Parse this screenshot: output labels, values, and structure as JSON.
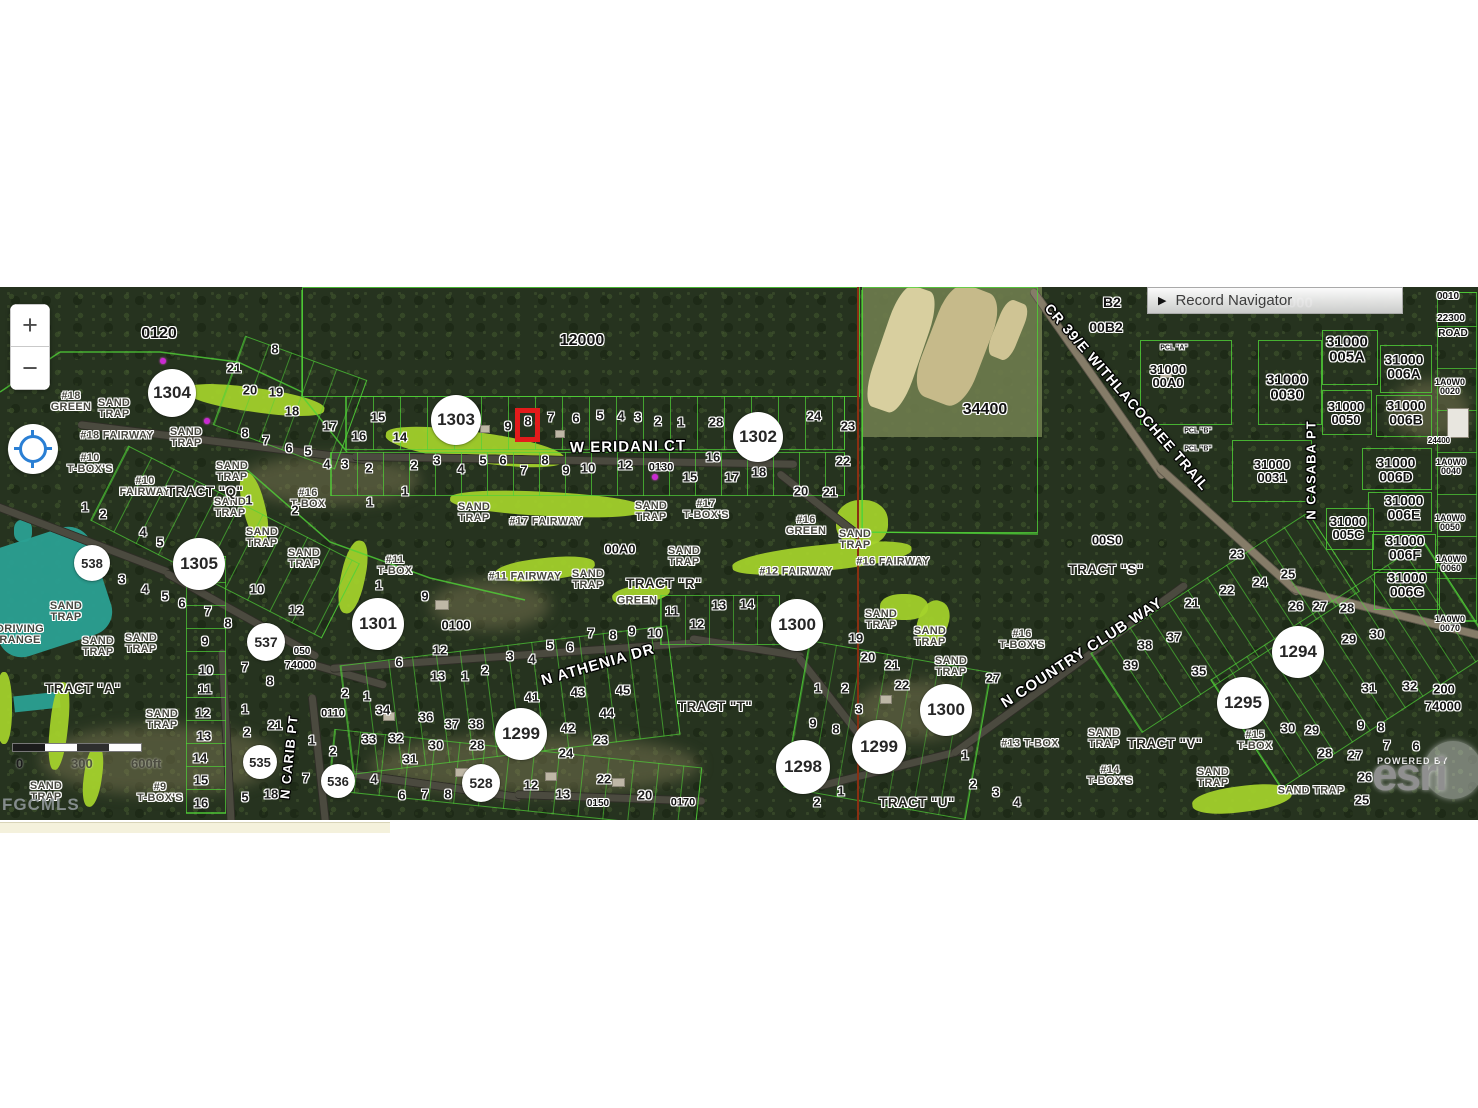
{
  "map": {
    "top": 287,
    "controls": {
      "zoom_in": "+",
      "zoom_out": "−"
    },
    "record_navigator": {
      "arrow": "▶",
      "label": "Record Navigator"
    },
    "scale_bar": {
      "start": "0",
      "mid": "300",
      "end": "600ft"
    },
    "attribution": {
      "powered_by": "POWERED BY",
      "brand": "esri",
      "mls": "FGCMLS"
    },
    "highlight": {
      "lot": "8",
      "x": 515,
      "y": 408,
      "w": 25,
      "h": 34,
      "color": "#e31b1b"
    },
    "circles": [
      [
        "1304",
        172,
        393,
        24
      ],
      [
        "1303",
        456,
        420,
        25
      ],
      [
        "1302",
        758,
        437,
        25
      ],
      [
        "538",
        92,
        563,
        18
      ],
      [
        "1305",
        199,
        564,
        26
      ],
      [
        "537",
        266,
        642,
        19
      ],
      [
        "1301",
        378,
        624,
        26
      ],
      [
        "1300",
        797,
        625,
        26
      ],
      [
        "1300",
        946,
        710,
        26
      ],
      [
        "1299",
        521,
        734,
        26
      ],
      [
        "1299",
        879,
        747,
        27
      ],
      [
        "1298",
        803,
        767,
        27
      ],
      [
        "1294",
        1298,
        652,
        26
      ],
      [
        "1295",
        1243,
        703,
        26
      ],
      [
        "535",
        260,
        762,
        17
      ],
      [
        "536",
        338,
        781,
        17
      ],
      [
        "528",
        481,
        783,
        19
      ]
    ],
    "streets": [
      [
        "W ERIDANI CT",
        628,
        447,
        -1,
        15
      ],
      [
        "N ATHENIA DR",
        598,
        665,
        -16,
        15
      ],
      [
        "N COUNTRY CLUB WAY",
        1082,
        653,
        -33,
        15
      ],
      [
        "CR 39/E WITHLACOCHEE TRAIL",
        1127,
        397,
        49,
        14
      ],
      [
        "N CASABA PT",
        1311,
        470,
        -90,
        13
      ],
      [
        "N CARIB PT",
        289,
        757,
        -84,
        13
      ]
    ],
    "tracts": [
      [
        "TRACT \"Q\"",
        205,
        492
      ],
      [
        "TRACT \"A\"",
        83,
        689
      ],
      [
        "TRACT \"R\"",
        664,
        584
      ],
      [
        "TRACT \"S\"",
        1106,
        570
      ],
      [
        "TRACT \"T\"",
        715,
        707
      ],
      [
        "TRACT \"U\"",
        917,
        803
      ],
      [
        "TRACT \"V\"",
        1165,
        744
      ]
    ],
    "golf": [
      [
        "#18\nGREEN",
        71,
        402
      ],
      [
        "SAND\nTRAP",
        114,
        409
      ],
      [
        "SAND\nTRAP",
        186,
        438
      ],
      [
        "#18 FAIRWAY",
        117,
        436
      ],
      [
        "#10\nT-BOX'S",
        90,
        464
      ],
      [
        "#10\nFAIRWAY",
        145,
        487
      ],
      [
        "SAND\nTRAP",
        232,
        472
      ],
      [
        "SAND\nTRAP",
        230,
        508
      ],
      [
        "#16\nT-BOX",
        308,
        499
      ],
      [
        "SAND\nTRAP",
        262,
        538
      ],
      [
        "SAND\nTRAP",
        304,
        559
      ],
      [
        "SAND\nTRAP",
        474,
        513
      ],
      [
        "#17 FAIRWAY",
        546,
        522
      ],
      [
        "#17\nT-BOX'S",
        706,
        510
      ],
      [
        "SAND\nTRAP",
        651,
        512
      ],
      [
        "SAND\nTRAP",
        684,
        557
      ],
      [
        "#11\nT-BOX",
        395,
        566
      ],
      [
        "#11 FAIRWAY",
        525,
        577
      ],
      [
        "SAND\nTRAP",
        588,
        580
      ],
      [
        "GREEN",
        637,
        601
      ],
      [
        "#12 FAIRWAY",
        796,
        572
      ],
      [
        "#16\nGREEN",
        806,
        526
      ],
      [
        "SAND\nTRAP",
        855,
        540
      ],
      [
        "#16 FAIRWAY",
        893,
        562
      ],
      [
        "SAND\nTRAP",
        881,
        620
      ],
      [
        "SAND\nTRAP",
        930,
        637
      ],
      [
        "SAND\nTRAP",
        951,
        667
      ],
      [
        "#16\nT-BOX'S",
        1022,
        640
      ],
      [
        "SAND\nTRAP",
        66,
        612
      ],
      [
        "SAND\nTRAP",
        98,
        647
      ],
      [
        "SAND\nTRAP",
        141,
        644
      ],
      [
        "SAND\nTRAP",
        162,
        720
      ],
      [
        "SAND\nTRAP",
        46,
        792
      ],
      [
        "#9\nT-BOX'S",
        160,
        793
      ],
      [
        "DRIVING\nRANGE",
        20,
        635
      ],
      [
        "#13 T-BOX",
        1030,
        744
      ],
      [
        "SAND\nTRAP",
        1104,
        739
      ],
      [
        "#14\nT-BOX'S",
        1110,
        776
      ],
      [
        "#15\nT-BOX",
        1255,
        741
      ],
      [
        "SAND\nTRAP",
        1213,
        778
      ],
      [
        "SAND TRAP",
        1311,
        791
      ]
    ],
    "parcels": [
      [
        "0120",
        159,
        334,
        16
      ],
      [
        "12000",
        582,
        341,
        16
      ],
      [
        "34400",
        985,
        410,
        16
      ],
      [
        "B2",
        1112,
        302,
        14
      ],
      [
        "00B2",
        1106,
        327,
        14
      ],
      [
        "0010",
        1448,
        297,
        10
      ],
      [
        "22300",
        1451,
        319,
        10
      ],
      [
        "ROAD",
        1453,
        334,
        10
      ],
      [
        "PCL \"A\"",
        1174,
        348,
        7
      ],
      [
        "31000\n00A0",
        1168,
        376,
        13
      ],
      [
        "PCL \"B\"",
        1198,
        431,
        7
      ],
      [
        "PCL \"B\"",
        1198,
        449,
        7
      ],
      [
        "31000\n005A",
        1347,
        350,
        15
      ],
      [
        "31000\n006A",
        1404,
        367,
        14
      ],
      [
        "31000\n0030",
        1287,
        388,
        15
      ],
      [
        "31000\n0050",
        1346,
        413,
        13
      ],
      [
        "31000\n006B",
        1406,
        413,
        14
      ],
      [
        "1A0W0\n0020",
        1450,
        387,
        9
      ],
      [
        "24400",
        1439,
        441,
        8
      ],
      [
        "31000\n0031",
        1272,
        471,
        13
      ],
      [
        "31000\n006D",
        1396,
        470,
        14
      ],
      [
        "1A0W0\n0040",
        1451,
        467,
        9
      ],
      [
        "31000\n006E",
        1404,
        508,
        14
      ],
      [
        "31000\n005C",
        1348,
        528,
        13
      ],
      [
        "1A0W0\n0050",
        1450,
        523,
        9
      ],
      [
        "31000\n006F",
        1405,
        548,
        14
      ],
      [
        "1A0W0\n0060",
        1451,
        564,
        9
      ],
      [
        "31000\n006G",
        1407,
        585,
        14
      ],
      [
        "1A0W0\n0070",
        1450,
        624,
        9
      ],
      [
        "00S0",
        1107,
        540,
        13
      ],
      [
        "00A0",
        620,
        549,
        13
      ],
      [
        "0130",
        661,
        468,
        11
      ],
      [
        "0100",
        456,
        625,
        13
      ],
      [
        "0110",
        333,
        714,
        11
      ],
      [
        "050",
        302,
        652,
        10
      ],
      [
        "74000",
        300,
        666,
        11
      ],
      [
        "200",
        1444,
        689,
        13
      ],
      [
        "74000",
        1443,
        706,
        13
      ],
      [
        "0150",
        598,
        804,
        10
      ],
      [
        "0170",
        683,
        803,
        11
      ],
      [
        "41000",
        1292,
        303,
        15,
        "ghost"
      ]
    ],
    "lots": [
      [
        "8",
        275,
        349
      ],
      [
        "21",
        234,
        368
      ],
      [
        "20",
        250,
        390
      ],
      [
        "19",
        276,
        392
      ],
      [
        "18",
        292,
        411
      ],
      [
        "8",
        245,
        433
      ],
      [
        "7",
        266,
        440
      ],
      [
        "6",
        289,
        448
      ],
      [
        "5",
        308,
        451
      ],
      [
        "1",
        249,
        500
      ],
      [
        "2",
        295,
        510
      ],
      [
        "17",
        330,
        426
      ],
      [
        "16",
        359,
        436
      ],
      [
        "15",
        378,
        417
      ],
      [
        "14",
        400,
        437
      ],
      [
        "4",
        327,
        464
      ],
      [
        "3",
        345,
        464
      ],
      [
        "2",
        369,
        468
      ],
      [
        "1",
        405,
        491
      ],
      [
        "1",
        370,
        502
      ],
      [
        "9",
        508,
        426
      ],
      [
        "8",
        528,
        421
      ],
      [
        "7",
        551,
        417
      ],
      [
        "6",
        576,
        418
      ],
      [
        "5",
        600,
        415
      ],
      [
        "4",
        621,
        416
      ],
      [
        "3",
        638,
        417
      ],
      [
        "2",
        658,
        421
      ],
      [
        "1",
        681,
        422
      ],
      [
        "28",
        716,
        422
      ],
      [
        "24",
        814,
        416
      ],
      [
        "23",
        848,
        426
      ],
      [
        "22",
        843,
        461
      ],
      [
        "20",
        801,
        491
      ],
      [
        "21",
        830,
        492
      ],
      [
        "16",
        713,
        457
      ],
      [
        "15",
        690,
        477
      ],
      [
        "17",
        732,
        477
      ],
      [
        "18",
        759,
        472
      ],
      [
        "2",
        414,
        465
      ],
      [
        "3",
        437,
        460
      ],
      [
        "4",
        461,
        469
      ],
      [
        "5",
        483,
        460
      ],
      [
        "6",
        503,
        460
      ],
      [
        "7",
        524,
        470
      ],
      [
        "8",
        545,
        460
      ],
      [
        "9",
        566,
        470
      ],
      [
        "10",
        588,
        468
      ],
      [
        "12",
        625,
        465
      ],
      [
        "1",
        85,
        507
      ],
      [
        "2",
        103,
        514
      ],
      [
        "4",
        143,
        532
      ],
      [
        "5",
        160,
        542
      ],
      [
        "3",
        122,
        579
      ],
      [
        "4",
        145,
        589
      ],
      [
        "5",
        165,
        596
      ],
      [
        "6",
        182,
        603
      ],
      [
        "7",
        208,
        611
      ],
      [
        "8",
        228,
        623
      ],
      [
        "9",
        205,
        641
      ],
      [
        "10",
        257,
        589
      ],
      [
        "12",
        296,
        610
      ],
      [
        "10",
        206,
        670
      ],
      [
        "11",
        205,
        689
      ],
      [
        "12",
        203,
        713
      ],
      [
        "13",
        204,
        736
      ],
      [
        "14",
        200,
        758
      ],
      [
        "15",
        201,
        780
      ],
      [
        "16",
        201,
        803
      ],
      [
        "7",
        245,
        667
      ],
      [
        "8",
        270,
        681
      ],
      [
        "1",
        245,
        709
      ],
      [
        "2",
        247,
        732
      ],
      [
        "21",
        275,
        725
      ],
      [
        "1",
        312,
        740
      ],
      [
        "2",
        333,
        751
      ],
      [
        "5",
        245,
        797
      ],
      [
        "18",
        271,
        794
      ],
      [
        "7",
        306,
        778
      ],
      [
        "1",
        379,
        585
      ],
      [
        "9",
        425,
        596
      ],
      [
        "12",
        440,
        650
      ],
      [
        "6",
        399,
        662
      ],
      [
        "13",
        438,
        676
      ],
      [
        "1",
        465,
        676
      ],
      [
        "2",
        485,
        670
      ],
      [
        "3",
        510,
        656
      ],
      [
        "4",
        532,
        659
      ],
      [
        "5",
        550,
        645
      ],
      [
        "6",
        570,
        647
      ],
      [
        "7",
        591,
        633
      ],
      [
        "8",
        613,
        635
      ],
      [
        "9",
        632,
        631
      ],
      [
        "10",
        655,
        633
      ],
      [
        "11",
        672,
        611
      ],
      [
        "12",
        697,
        624
      ],
      [
        "13",
        719,
        605
      ],
      [
        "14",
        747,
        604
      ],
      [
        "2",
        345,
        693
      ],
      [
        "1",
        367,
        696
      ],
      [
        "34",
        383,
        710
      ],
      [
        "36",
        426,
        717
      ],
      [
        "37",
        452,
        724
      ],
      [
        "38",
        476,
        724
      ],
      [
        "33",
        369,
        739
      ],
      [
        "32",
        396,
        738
      ],
      [
        "30",
        436,
        745
      ],
      [
        "28",
        477,
        745
      ],
      [
        "31",
        410,
        759
      ],
      [
        "41",
        532,
        697
      ],
      [
        "43",
        578,
        692
      ],
      [
        "45",
        623,
        690
      ],
      [
        "44",
        607,
        713
      ],
      [
        "42",
        568,
        728
      ],
      [
        "23",
        601,
        740
      ],
      [
        "24",
        566,
        753
      ],
      [
        "4",
        374,
        779
      ],
      [
        "6",
        402,
        795
      ],
      [
        "7",
        425,
        794
      ],
      [
        "8",
        448,
        794
      ],
      [
        "12",
        531,
        785
      ],
      [
        "13",
        563,
        794
      ],
      [
        "22",
        604,
        779
      ],
      [
        "20",
        645,
        795
      ],
      [
        "19",
        856,
        638
      ],
      [
        "20",
        868,
        657
      ],
      [
        "21",
        892,
        665
      ],
      [
        "22",
        902,
        685
      ],
      [
        "1",
        818,
        688
      ],
      [
        "2",
        845,
        688
      ],
      [
        "3",
        859,
        709
      ],
      [
        "9",
        813,
        723
      ],
      [
        "8",
        836,
        729
      ],
      [
        "1",
        841,
        791
      ],
      [
        "2",
        817,
        802
      ],
      [
        "1",
        965,
        755
      ],
      [
        "2",
        973,
        784
      ],
      [
        "3",
        996,
        792
      ],
      [
        "4",
        1017,
        802
      ],
      [
        "27",
        993,
        678
      ],
      [
        "38",
        1145,
        645
      ],
      [
        "37",
        1174,
        637
      ],
      [
        "39",
        1131,
        665
      ],
      [
        "35",
        1199,
        671
      ],
      [
        "21",
        1192,
        603
      ],
      [
        "22",
        1227,
        590
      ],
      [
        "23",
        1237,
        554
      ],
      [
        "24",
        1260,
        582
      ],
      [
        "25",
        1288,
        574
      ],
      [
        "26",
        1296,
        606
      ],
      [
        "27",
        1320,
        606
      ],
      [
        "28",
        1347,
        608
      ],
      [
        "29",
        1349,
        639
      ],
      [
        "30",
        1377,
        634
      ],
      [
        "31",
        1369,
        688
      ],
      [
        "32",
        1410,
        686
      ],
      [
        "30",
        1288,
        728
      ],
      [
        "29",
        1312,
        730
      ],
      [
        "28",
        1325,
        753
      ],
      [
        "9",
        1361,
        725
      ],
      [
        "8",
        1381,
        727
      ],
      [
        "7",
        1387,
        745
      ],
      [
        "6",
        1416,
        746
      ],
      [
        "27",
        1355,
        755
      ],
      [
        "26",
        1365,
        777
      ],
      [
        "25",
        1362,
        800
      ]
    ]
  },
  "colors": {
    "parcel_line": "#4fd337",
    "fairway": "#a5d32b",
    "driving_range": "#2aa092",
    "highlight": "#e31b1b",
    "section_line": "#8a2f12"
  }
}
